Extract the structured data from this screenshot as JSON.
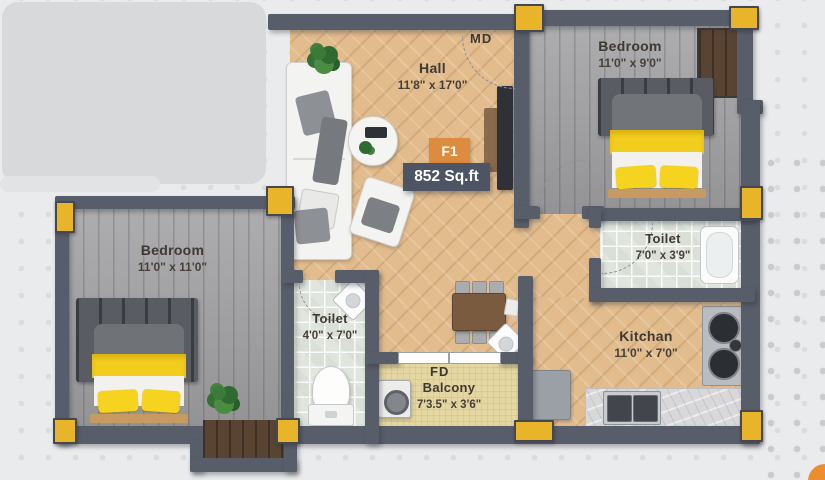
{
  "floorplan": {
    "unit": {
      "badge": "F1",
      "area": "852 Sq.ft"
    },
    "door_labels": {
      "main_door": "MD",
      "folding_door": "FD"
    },
    "rooms": {
      "hall": {
        "name": "Hall",
        "dims": "11'8\" x 17'0\""
      },
      "bedroom_tr": {
        "name": "Bedroom",
        "dims": "11'0\" x 9'0\""
      },
      "bedroom_l": {
        "name": "Bedroom",
        "dims": "11'0\" x 11'0\""
      },
      "toilet_r": {
        "name": "Toilet",
        "dims": "7'0\" x 3'9\""
      },
      "toilet_l": {
        "name": "Toilet",
        "dims": "4'0\" x 7'0\""
      },
      "kitchen": {
        "name": "Kitchan",
        "dims": "11'0\" x 7'0\""
      },
      "balcony": {
        "name": "Balcony",
        "dims": "7'3.5\" x 3'6\""
      }
    },
    "colors": {
      "wall": "#575d69",
      "column": "#e7b42a",
      "badge": "#dd8c3f",
      "area_box": "#4d5464",
      "hall_floor": "#e2bc8d",
      "bedroom_floor": "#a4a4a7",
      "toilet_floor": "#e0e5dd",
      "balcony_floor": "#e5d7a1",
      "text": "#3f3933"
    }
  }
}
